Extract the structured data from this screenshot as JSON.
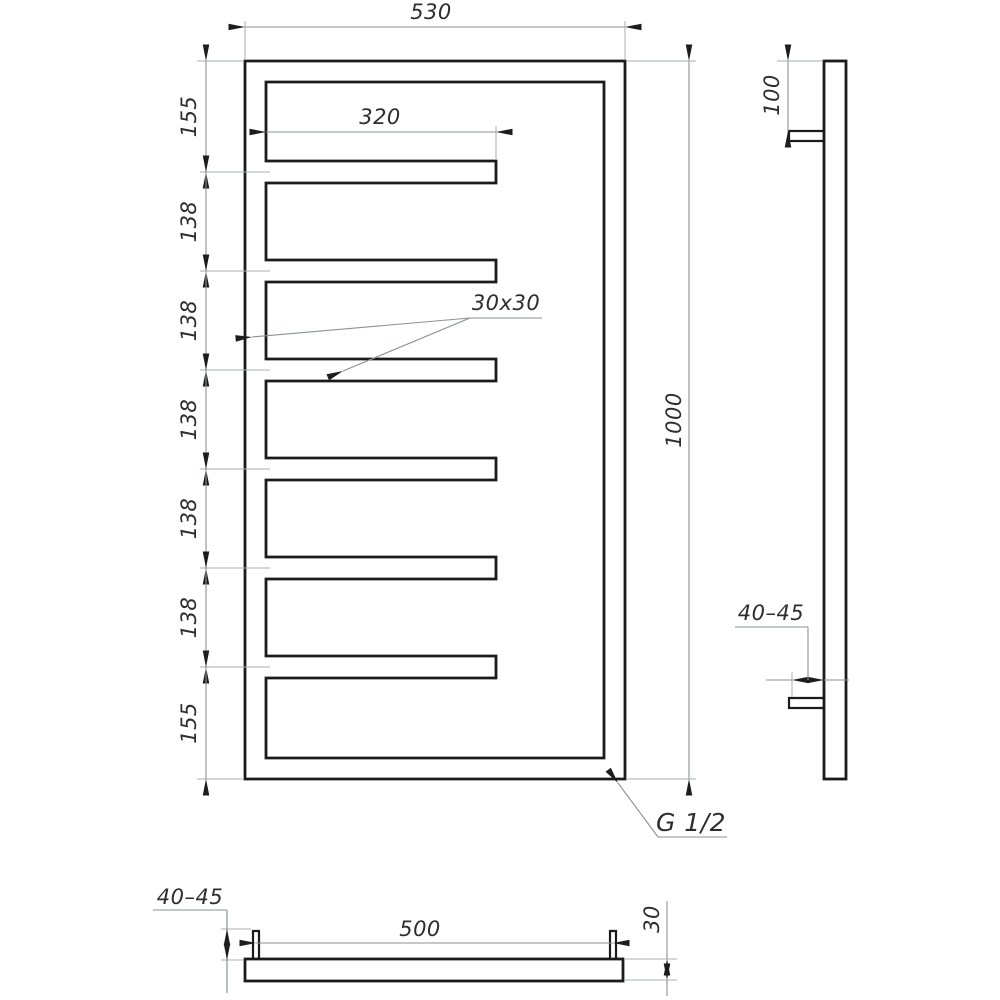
{
  "views": {
    "front": {
      "width": "530",
      "height": "1000",
      "bar_length": "320",
      "profile": "30x30",
      "segments": [
        "155",
        "138",
        "138",
        "138",
        "138",
        "138",
        "155"
      ],
      "connection": "G 1/2"
    },
    "side": {
      "top_offset": "100",
      "wall_gap": "40–45"
    },
    "bottom": {
      "bracket_spacing": "500",
      "wall_gap": "40–45",
      "depth": "30"
    }
  },
  "colors": {
    "contour_line": "#1b1b1b",
    "dimension_line": "#8b9196",
    "extension_line": "#a9afb4",
    "text": "#2e2e2e",
    "background": "#ffffff"
  }
}
